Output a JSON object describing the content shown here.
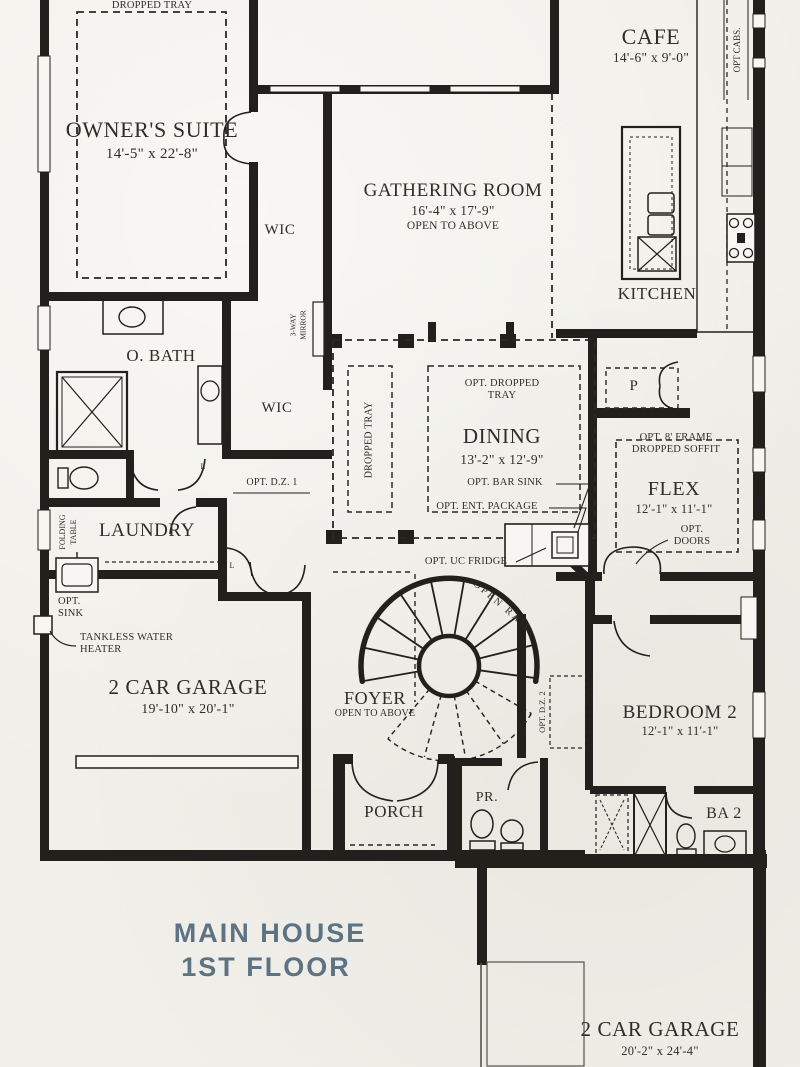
{
  "plan": {
    "title_line1": "MAIN HOUSE",
    "title_line2": "1ST FLOOR",
    "title_color": "#5b7383",
    "ink_color": "#221f1c",
    "paper_color": "#f1efe9"
  },
  "rooms": {
    "owners_suite": {
      "name": "OWNER'S SUITE",
      "dims": "14'-5\" x 22'-8\""
    },
    "cafe": {
      "name": "CAFE",
      "dims": "14'-6\" x 9'-0\""
    },
    "gathering_room": {
      "name": "GATHERING ROOM",
      "dims": "16'-4\" x 17'-9\"",
      "note": "OPEN TO ABOVE"
    },
    "kitchen": {
      "name": "KITCHEN"
    },
    "owners_bath": {
      "name": "O. BATH"
    },
    "wic_upper": {
      "name": "WIC"
    },
    "wic_lower": {
      "name": "WIC"
    },
    "dining": {
      "name": "DINING",
      "dims": "13'-2\" x 12'-9\""
    },
    "pantry": {
      "name": "P"
    },
    "flex": {
      "name": "FLEX",
      "dims": "12'-1\" x 11'-1\""
    },
    "laundry": {
      "name": "LAUNDRY"
    },
    "garage_main": {
      "name": "2 CAR GARAGE",
      "dims": "19'-10\" x 20'-1\""
    },
    "foyer": {
      "name": "FOYER",
      "note": "OPEN TO ABOVE"
    },
    "bedroom_2": {
      "name": "BEDROOM 2",
      "dims": "12'-1\" x 11'-1\""
    },
    "porch": {
      "name": "PORCH"
    },
    "powder_room": {
      "name": "PR."
    },
    "bath_2": {
      "name": "BA 2"
    },
    "garage_rear": {
      "name": "2 CAR GARAGE",
      "dims": "20'-2\" x 24'-4\""
    }
  },
  "annotations": {
    "dropped_tray": "DROPPED TRAY",
    "dropped_tray_vertical": "DROPPED TRAY",
    "opt_dropped_tray": "OPT. DROPPED TRAY",
    "opt_cabs": "OPT CABS.",
    "three_way_mirror": "3-WAY MIRROR",
    "opt_dz_1": "OPT. D.Z. 1",
    "opt_dz_2": "OPT. D.Z. 2",
    "opt_bar_sink": "OPT. BAR SINK",
    "opt_ent_package": "OPT. ENT. PACKAGE",
    "opt_uc_fridge": "OPT. UC FRIDGE",
    "opt_frame_soffit": "OPT. 8' FRAME DROPPED SOFFIT",
    "opt_doors": "OPT. DOORS",
    "folding_table": "FOLDING TABLE",
    "opt_sink": "OPT. SINK",
    "tankless_water_heater": "TANKLESS WATER HEATER",
    "open_rail": "OPEN RAIL",
    "linen_1": "L",
    "linen_2": "L"
  }
}
